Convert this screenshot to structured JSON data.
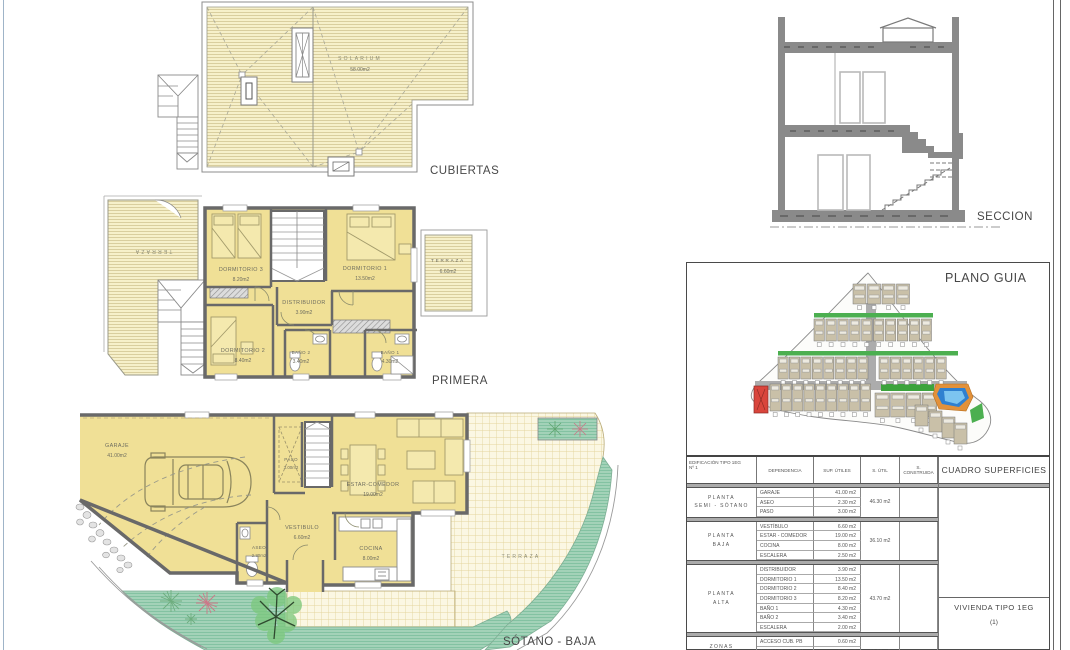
{
  "plans": {
    "cubiertas": {
      "title": "CUBIERTAS",
      "solarium": {
        "name": "SOLARIUM",
        "area": "58.00m2"
      }
    },
    "primera": {
      "title": "PRIMERA",
      "rooms": {
        "dormitorio3": {
          "name": "DORMITORIO 3",
          "area": "8.20m2"
        },
        "dormitorio1": {
          "name": "DORMITORIO 1",
          "area": "13.50m2"
        },
        "dormitorio2": {
          "name": "DORMITORIO 2",
          "area": "8.40m2"
        },
        "distribuidor": {
          "name": "DISTRIBUIDOR",
          "area": "3.90m2"
        },
        "bano2": {
          "name": "BAÑO 2",
          "area": "3.40m2"
        },
        "bano1": {
          "name": "BAÑO 1",
          "area": "4.30m2"
        },
        "terraza": {
          "name": "TERRAZA",
          "area": "6.60m2"
        },
        "terraza_izq": {
          "name": "TERRAZA"
        }
      }
    },
    "sotano": {
      "title": "SÓTANO - BAJA",
      "rooms": {
        "garaje": {
          "name": "GARAJE",
          "area": "41.00m2"
        },
        "paso": {
          "name": "PASO",
          "area": "3.00m2"
        },
        "estar": {
          "name": "ESTAR-COMEDOR",
          "area": "19.00m2"
        },
        "vestibulo": {
          "name": "VESTIBULO",
          "area": "6.60m2"
        },
        "aseo": {
          "name": "ASEO",
          "area": "2.30m2"
        },
        "cocina": {
          "name": "COCINA",
          "area": "8.00m2"
        },
        "terraza": {
          "name": "TERRAZA"
        }
      }
    },
    "seccion": {
      "title": "SECCION"
    },
    "plano_guia": {
      "title": "PLANO GUIA"
    }
  },
  "cuadro": {
    "title": "CUADRO SUPERFICIES",
    "columns": {
      "edificacion": "EDIFICACIÓN TIPO 1EG",
      "edificacion2": "Nº 1",
      "dependencia": "DEPENDENCIA",
      "sup_utiles": "SUP. ÚTILES",
      "s_util": "S. ÚTIL",
      "s_construida": "S. CONSTRUIDA"
    },
    "groups": [
      {
        "planta": [
          "PLANTA",
          "SEMI - SÓTANO"
        ],
        "rows": [
          {
            "dep": "GARAJE",
            "sup": "41.00 m2"
          },
          {
            "dep": "ASEO",
            "sup": "2.30 m2"
          },
          {
            "dep": "PASO",
            "sup": "3.00 m2"
          }
        ],
        "s_util": "46.30 m2"
      },
      {
        "planta": [
          "PLANTA",
          "BAJA"
        ],
        "rows": [
          {
            "dep": "VESTÍBULO",
            "sup": "6.60 m2"
          },
          {
            "dep": "ESTAR - COMEDOR",
            "sup": "19.00 m2"
          },
          {
            "dep": "COCINA",
            "sup": "8.00 m2"
          },
          {
            "dep": "ESCALERA",
            "sup": "2.50 m2"
          }
        ],
        "s_util": "36.10 m2"
      },
      {
        "planta": [
          "PLANTA",
          "ALTA"
        ],
        "rows": [
          {
            "dep": "DISTRIBUIDOR",
            "sup": "3.90 m2"
          },
          {
            "dep": "DORMITORIO 1",
            "sup": "13.50 m2"
          },
          {
            "dep": "DORMITORIO 2",
            "sup": "8.40 m2"
          },
          {
            "dep": "DORMITORIO 3",
            "sup": "8.20 m2"
          },
          {
            "dep": "BAÑO 1",
            "sup": "4.30 m2"
          },
          {
            "dep": "BAÑO 2",
            "sup": "3.40 m2"
          },
          {
            "dep": "ESCALERA",
            "sup": "2.00 m2"
          }
        ],
        "s_util": "43.70 m2"
      },
      {
        "planta": [
          "ZONAS",
          "EXTERIORES"
        ],
        "rows": [
          {
            "dep": "ACCESO CUB. PB",
            "sup": "0.60 m2"
          },
          {
            "dep": "TERRAZA CUB. PA",
            "sup": "6.60 m2"
          },
          {
            "dep": "SOLARIUM-ESCAL.",
            "sup": "58.00 m2"
          }
        ],
        "s_util": "65.20 m2"
      }
    ],
    "vivienda": "VIVIENDA TIPO 1EG",
    "vivienda_num": "(1)"
  },
  "colors": {
    "hatch_yellow": "#F6F0CA",
    "room_yellow": "#F0E096",
    "wall_gray": "#696969",
    "grid_cream": "#FBF7E3",
    "garden_green": "#A3D2B8",
    "site_green": "#4CAF50",
    "pool_blue": "#2F80D0",
    "deck_orange": "#E2913A",
    "unit_red": "#D9453C"
  }
}
